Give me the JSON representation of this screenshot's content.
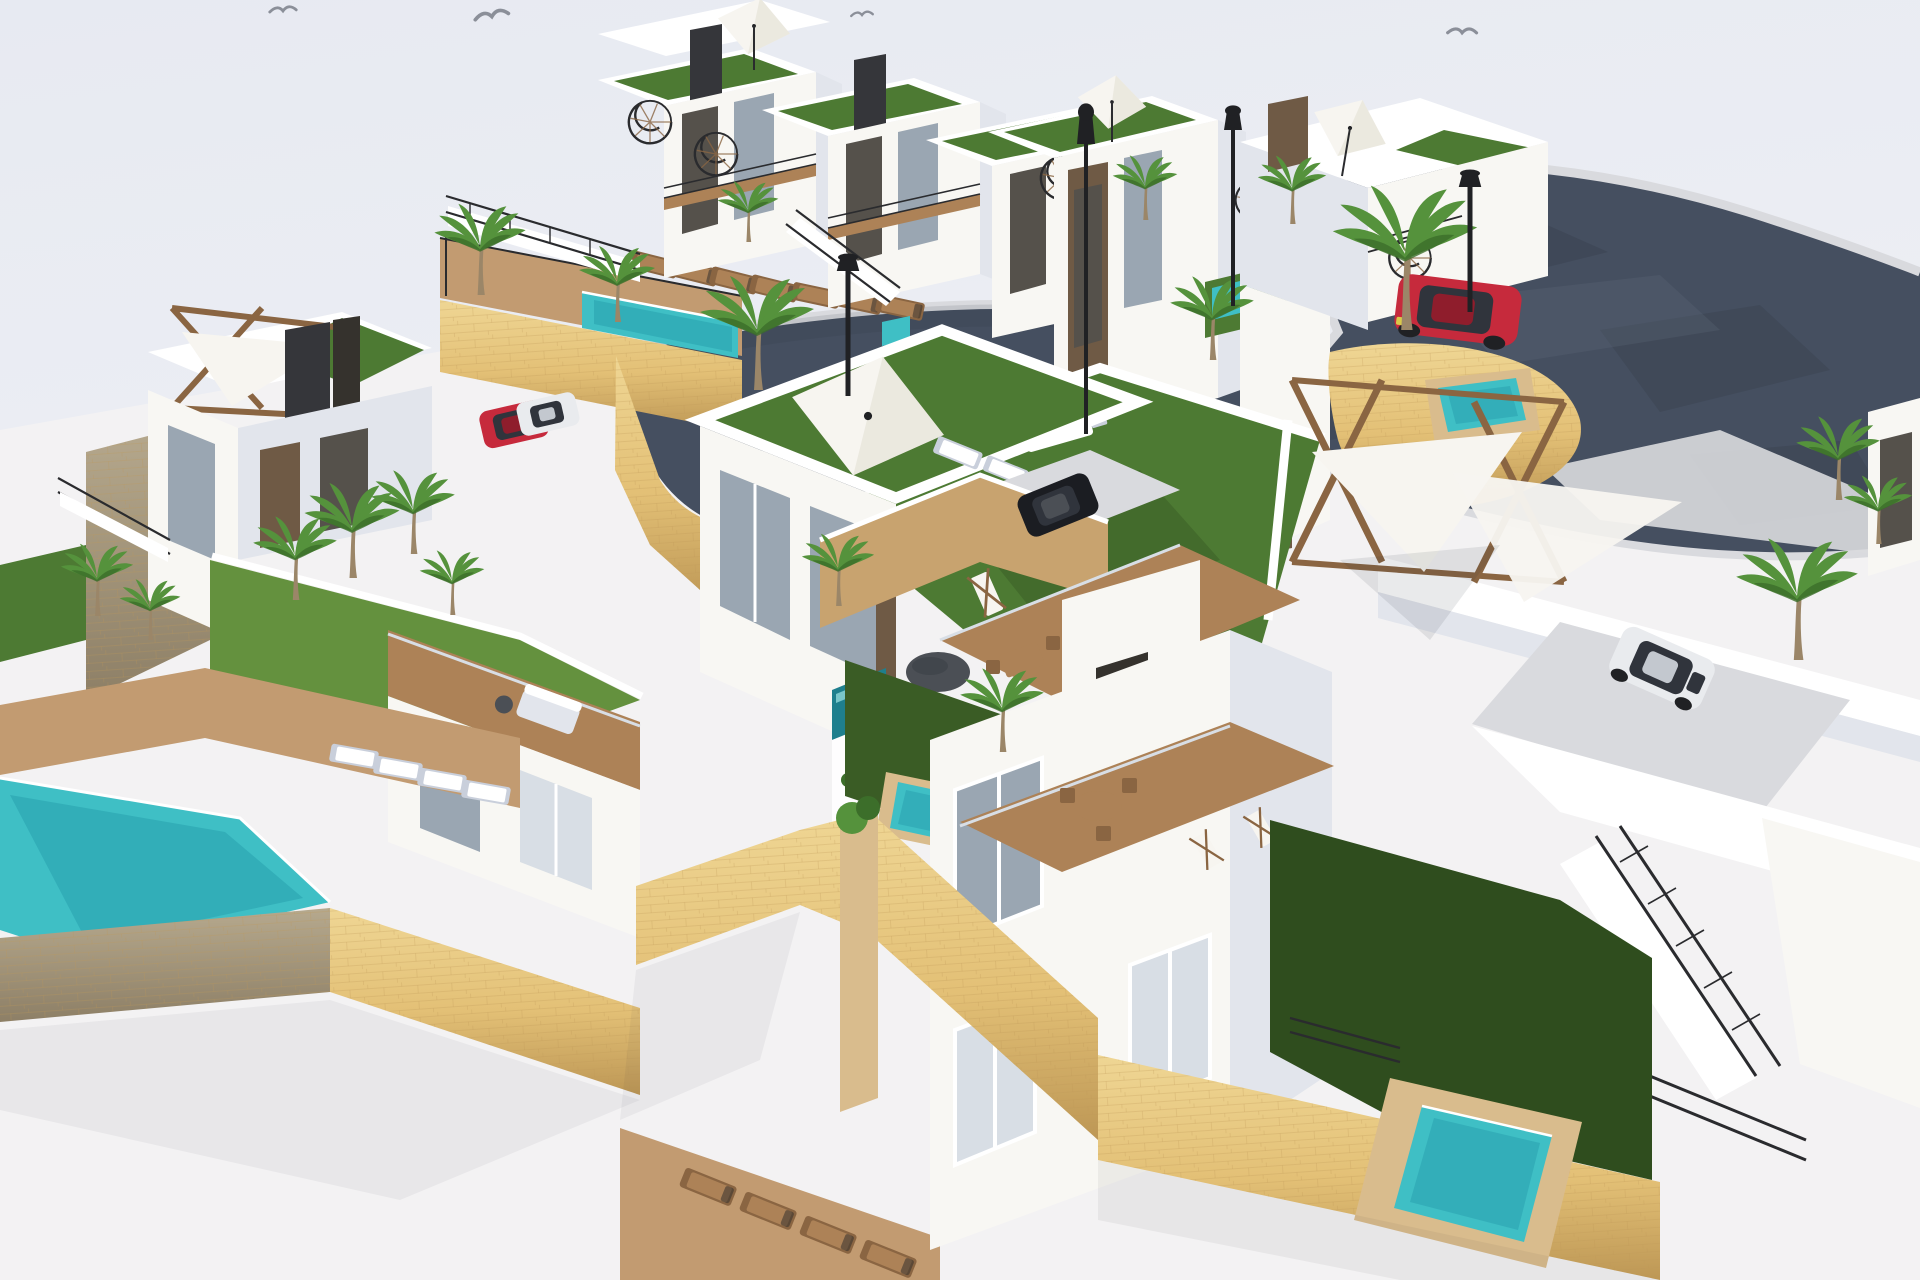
{
  "scene": {
    "description": "Aerial 3D architectural rendering of a hillside residential development: white modern villas and townhouses with green roof terraces, spiral staircases, sandy stone retaining walls, turquoise pools, palm trees, street lamps and a dark curving access road with parked cars.",
    "style": "CGI daylight render",
    "title": "Villa development aerial render"
  },
  "colors": {
    "sky_top": "#e7eaf2",
    "sky_bottom": "#f3f3f5",
    "ground": "#f3f2f3",
    "road": "#454f60",
    "road_dark": "#39424f",
    "road_light": "#5d6678",
    "sidewalk": "#d9dade",
    "stone": "#e3c076",
    "stone_light": "#efd694",
    "stone_dark": "#bd9755",
    "stone_gray": "#8d7f66",
    "stone_gray_light": "#b6a98e",
    "white": "#ffffff",
    "facade": "#f8f7f3",
    "shade": "#e2e5ec",
    "shade2": "#c9cfdb",
    "glass": "#9aa6b2",
    "glass_dark": "#55514b",
    "glass_light": "#d8dee5",
    "frame": "#35322d",
    "brown": "#6f5a45",
    "dark_panel": "#35363a",
    "lawn": "#4d7a33",
    "lawn_dark": "#3a5c25",
    "lawn_deep": "#2f4d1e",
    "lawn_bright": "#64913e",
    "pool": "#3fbfc5",
    "pool_deep": "#2ba4b0",
    "pool_light": "#9fe4e4",
    "pool_dark": "#1f7f8d",
    "wood": "#ad8257",
    "wood_dark": "#8a6542",
    "wood_light": "#c29b71",
    "tan": "#c8a36f",
    "tan_light": "#d9bc8d",
    "umbrella": "#f7f5f0",
    "umbrella_shade": "#e2ded2",
    "metal": "#202124",
    "rail": "#2a2b2e",
    "gray_dark": "#4b4f55",
    "car_red": "#c62a3c",
    "car_red_dark": "#8f1d2c",
    "car_white": "#e9ebee",
    "car_white_dark": "#c3c8cf",
    "car_black": "#1b1d22",
    "car_glass": "#30343c",
    "palm": "#55923c",
    "palm_dark": "#3c6e2a",
    "trunk": "#9b8668",
    "bird": "#8b8f99",
    "shadow": "#2c3138"
  },
  "objects": {
    "birds": 4,
    "street_lamps": 4,
    "palm_trees": 19,
    "buildings": [
      {
        "name": "top-townhouses",
        "units": 3,
        "features": [
          "green roof decks",
          "black spiral staircases",
          "white parasol",
          "balconies",
          "access stairs"
        ]
      },
      {
        "name": "tall-corner-building",
        "features": [
          "brown glazing bands",
          "roof parasol",
          "side lawn with plunge pool"
        ]
      },
      {
        "name": "right-street-building",
        "features": [
          "tilted parasol",
          "spiral staircase",
          "curved stone wall with plunge pool"
        ]
      },
      {
        "name": "left-villa",
        "features": [
          "shade-sail pergola roof terrace",
          "gray stone boundary wall",
          "palm lawn",
          "corner pool"
        ]
      },
      {
        "name": "center-villa",
        "features": [
          "roof lawn with large parasol",
          "sliding glass doors",
          "wood deck",
          "infinity edge water feature"
        ]
      },
      {
        "name": "garden-plot",
        "features": [
          "barbecue grill",
          "deck chairs",
          "pouf",
          "timber pergola with shade sails"
        ]
      },
      {
        "name": "bottom-house",
        "features": [
          "wood terrace with dining set",
          "sun loungers",
          "private garden pool",
          "outdoor staircase"
        ]
      }
    ],
    "pools": [
      {
        "name": "communal-pool-upper"
      },
      {
        "name": "townhouse-plunge-pool"
      },
      {
        "name": "tall-building-side-pool"
      },
      {
        "name": "street-corner-plunge-pool"
      },
      {
        "name": "bottom-left-pool"
      },
      {
        "name": "center-garden-pool"
      },
      {
        "name": "bottom-right-garden-pool"
      }
    ],
    "cars": [
      {
        "name": "red-suv-on-road",
        "color_key": "car_red"
      },
      {
        "name": "red-hatchback-parked",
        "color_key": "car_red"
      },
      {
        "name": "white-coupe-parked",
        "color_key": "car_white"
      },
      {
        "name": "black-sedan-parked",
        "color_key": "car_black"
      },
      {
        "name": "white-hatchback-driveway",
        "color_key": "car_white"
      }
    ],
    "furniture": {
      "brown_sun_loungers": 11,
      "white_sun_loungers": 8,
      "deck_chairs": 6,
      "dining_sets": 2,
      "sofa_sets": 1,
      "barbecue_grills": 1,
      "poufs": 2,
      "parasols": 4,
      "shade_sails": 3,
      "spiral_staircases": 5
    }
  }
}
